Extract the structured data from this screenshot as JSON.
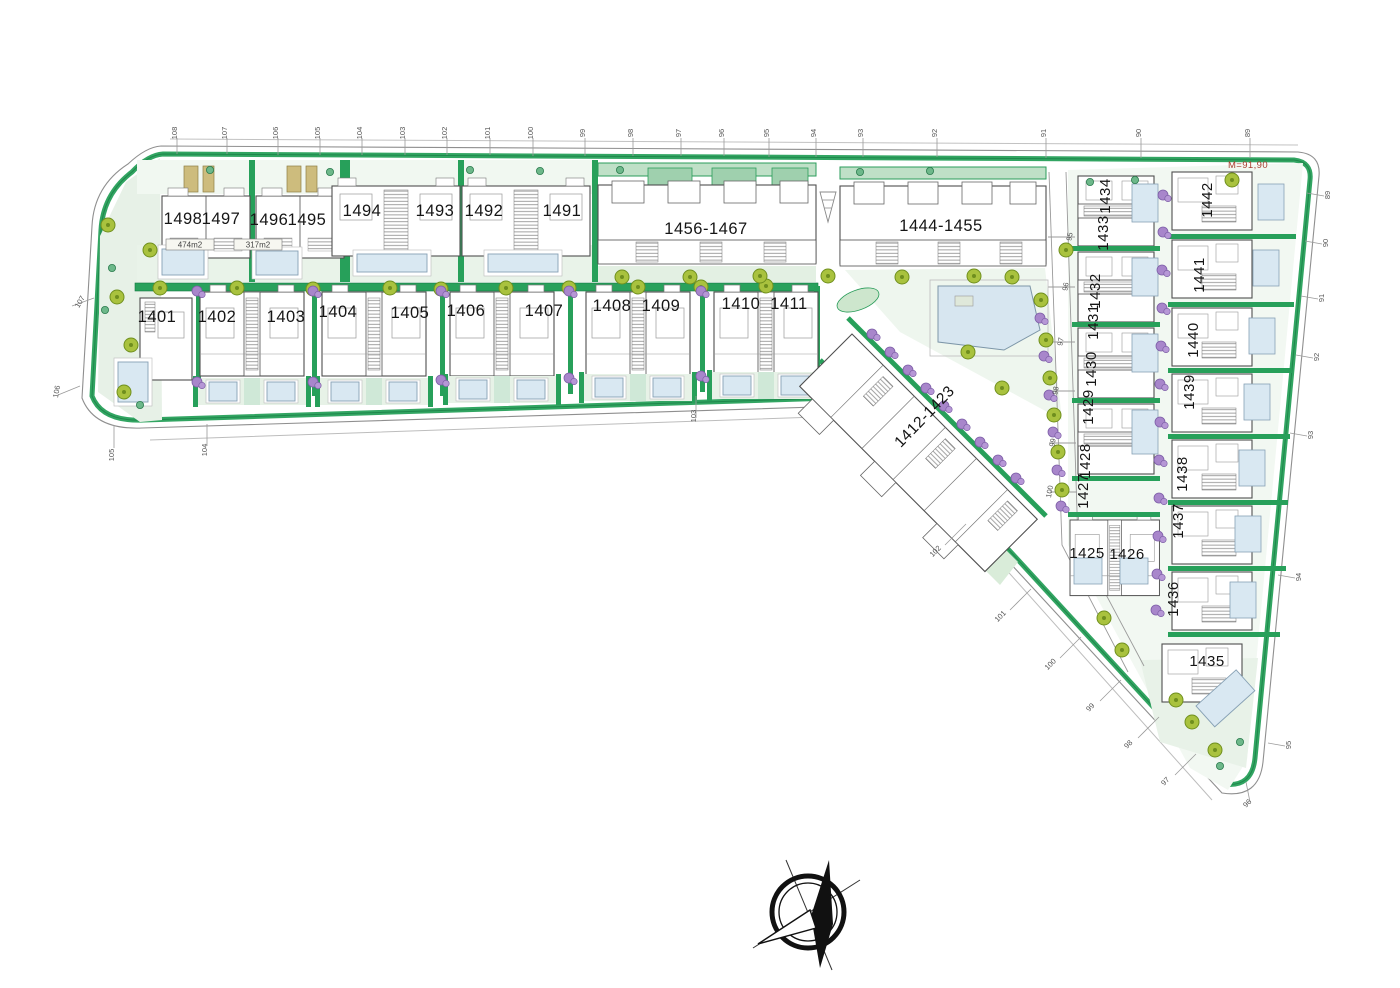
{
  "drawing": {
    "red_note": "M=91,90",
    "area_label_1": "474m2",
    "area_label_2": "317m2",
    "compass_icon": "north-arrow-compass"
  },
  "plots": {
    "row1": [
      "1498",
      "1497",
      "1496",
      "1495",
      "1494",
      "1493",
      "1492",
      "1491"
    ],
    "block_top": "1456-1467",
    "block_right": "1444-1455",
    "block_diagonal": "1412-1423",
    "row2": [
      "1401",
      "1402",
      "1403",
      "1404",
      "1405",
      "1406",
      "1407",
      "1408",
      "1409",
      "1410",
      "1411"
    ],
    "col_inner": [
      "1434",
      "1433",
      "1432",
      "1431",
      "1430",
      "1429",
      "1428",
      "1427"
    ],
    "pair_south": [
      "1425",
      "1426"
    ],
    "col_outer": [
      "1442",
      "1441",
      "1440",
      "1439",
      "1438",
      "1437",
      "1436",
      "1435"
    ]
  },
  "dimensions": {
    "top": [
      "108",
      "107",
      "106",
      "105",
      "104",
      "103",
      "102",
      "101",
      "100",
      "99",
      "98",
      "97",
      "96",
      "95",
      "94",
      "93",
      "92",
      "91",
      "90",
      "89"
    ],
    "right": [
      "89",
      "90",
      "91",
      "92",
      "93",
      "94",
      "95",
      "96"
    ],
    "diagonal": [
      "97",
      "98",
      "99",
      "100",
      "101",
      "102"
    ],
    "left": [
      "107",
      "106",
      "105",
      "104"
    ],
    "road": "103",
    "inner_road": [
      "95",
      "96",
      "97",
      "98",
      "99",
      "100"
    ]
  }
}
